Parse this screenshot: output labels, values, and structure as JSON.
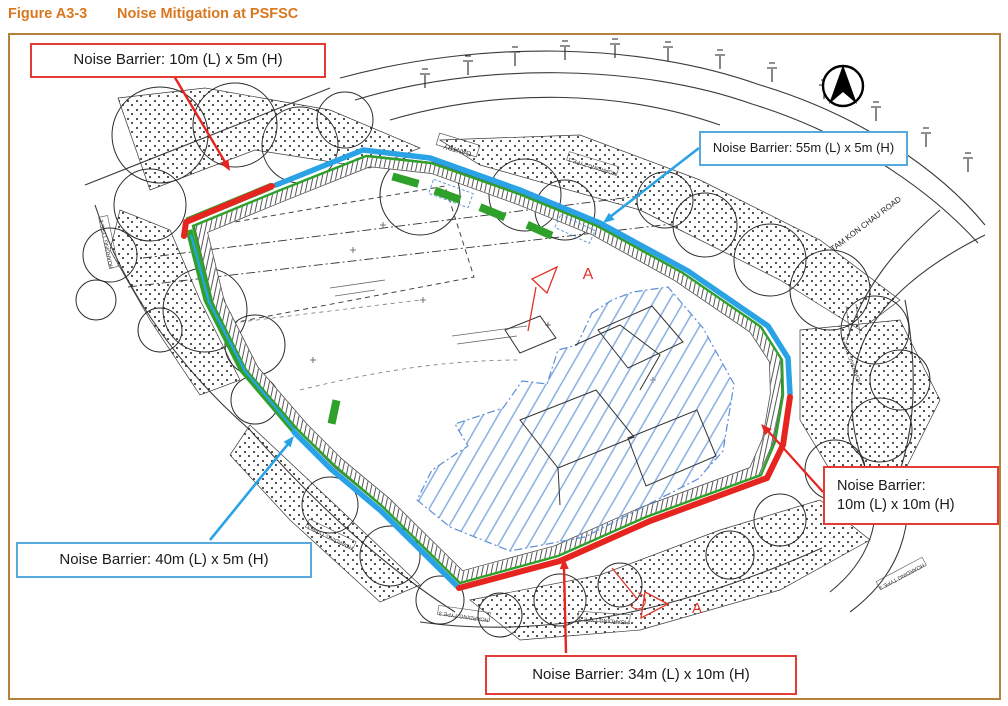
{
  "title": {
    "figure_no": "Figure A3-3",
    "caption": "Noise Mitigation at PSFSC"
  },
  "callouts": {
    "nb_10x5": {
      "text": "Noise Barrier: 10m (L) x 5m (H)",
      "border_color": "#e23c35"
    },
    "nb_55x5": {
      "text": "Noise Barrier: 55m (L) x 5m (H)",
      "border_color": "#58a9de"
    },
    "nb_40x5": {
      "text": "Noise Barrier: 40m (L) x 5m (H)",
      "border_color": "#58a9de"
    },
    "nb_10x10": {
      "line1": "Noise Barrier:",
      "line2": "10m (L) x 10m (H)",
      "border_color": "#e23c35"
    },
    "nb_34x10": {
      "text": "Noise Barrier: 34m (L) x 10m (H)",
      "border_color": "#e23c35"
    }
  },
  "plan_labels": {
    "road": "TAM KON CHAU ROAD",
    "gantry": "GANTRY",
    "hoarding_type_1": "HOARDING TYPE 1",
    "hoarding_type_3": "HOARDING TYPE 3",
    "section_marker": "A"
  },
  "colors": {
    "barrier_5m_blue": "#2aa3e6",
    "barrier_10m_red": "#e62420",
    "hoarding_green": "#2fa12b",
    "footprint_hatch_blue": "#7fa8dc",
    "figure_border_tan": "#b5823c",
    "title_orange": "#d9771e"
  }
}
